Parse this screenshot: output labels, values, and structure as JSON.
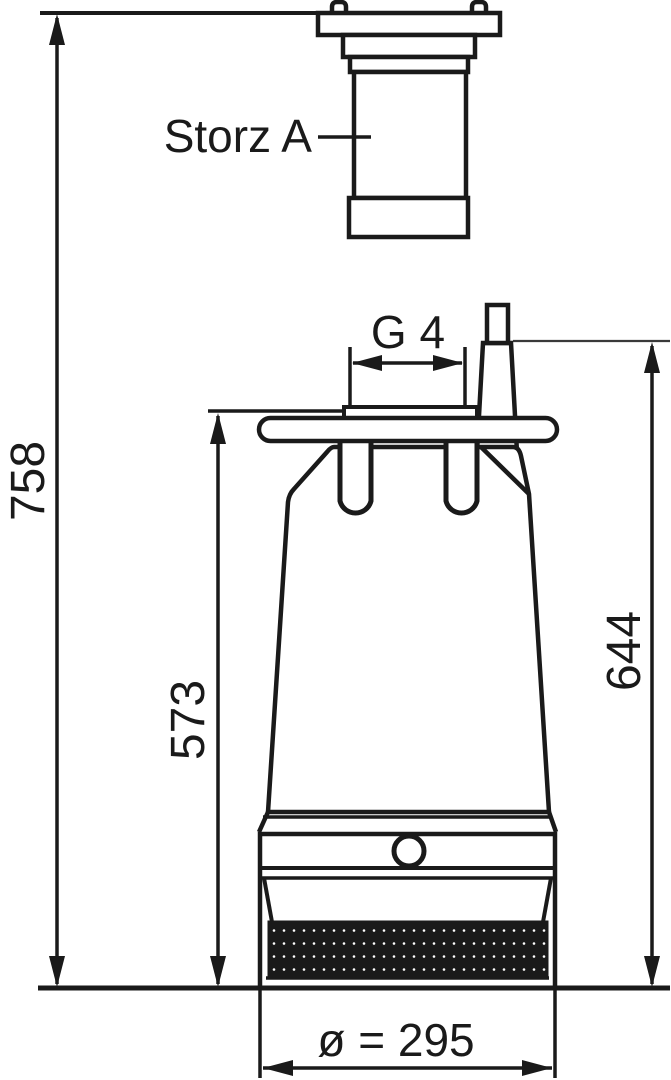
{
  "diagram": {
    "type": "technical-dimension-drawing",
    "subject": "Submersible drainage pump, side elevation with Storz A hose coupling and overall dimensions",
    "colors": {
      "line": "#1a1a1a",
      "thin_line": "#3a3a3a",
      "background": "#ffffff"
    },
    "dimensions": {
      "overall_height": "758",
      "body_height": "573",
      "vent_height": "644",
      "thread": "G 4",
      "base_diameter": "ø = 295"
    },
    "callouts": {
      "coupling": "Storz A"
    }
  }
}
